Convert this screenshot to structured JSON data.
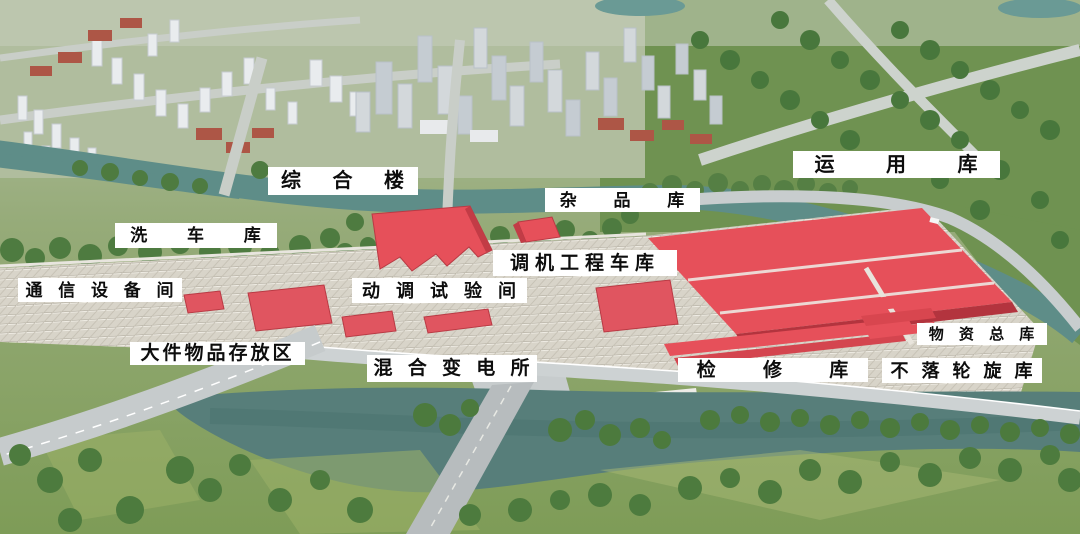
{
  "labels": [
    {
      "id": "comprehensive-building",
      "text": "综 合 楼"
    },
    {
      "id": "operation-depot",
      "text": "运 用 库"
    },
    {
      "id": "sundries-warehouse",
      "text": "杂 品 库"
    },
    {
      "id": "train-wash-depot",
      "text": "洗 车 库"
    },
    {
      "id": "shunting-engineering-vehicle-depot",
      "text": "调机工程车库"
    },
    {
      "id": "communication-equipment-room",
      "text": "通 信 设 备 间"
    },
    {
      "id": "dynamic-test-room",
      "text": "动 调 试 验 间"
    },
    {
      "id": "bulky-items-storage-area",
      "text": "大件物品存放区"
    },
    {
      "id": "mixed-substation",
      "text": "混 合 变 电 所"
    },
    {
      "id": "maintenance-depot",
      "text": "检 修 库"
    },
    {
      "id": "materials-main-warehouse",
      "text": "物 资 总 库"
    },
    {
      "id": "underfloor-wheel-lathe-depot",
      "text": "不 落 轮 旋 库"
    }
  ],
  "colors": {
    "highlight_red": "#e6505a",
    "highlight_red_dark": "#b93a44",
    "river": "#5e8d88",
    "truss_roof": "#d8d4c9",
    "label_background": "#ffffff",
    "label_text": "#0d0d0d"
  }
}
